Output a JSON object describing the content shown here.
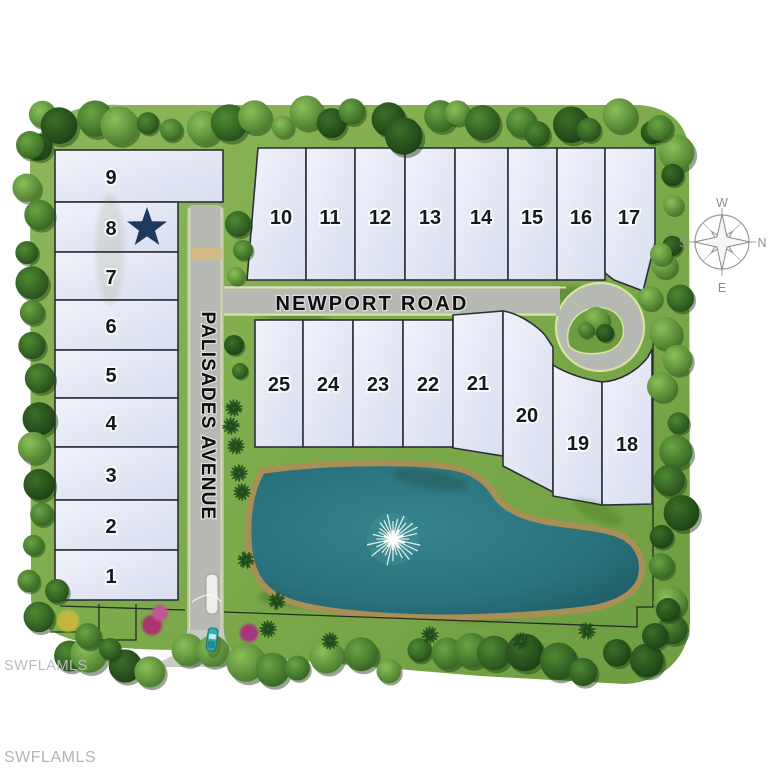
{
  "map": {
    "roads": {
      "newport": "NEWPORT ROAD",
      "palisades": "PALISADES AVENUE"
    },
    "lots": {
      "left_column": [
        "9",
        "8",
        "7",
        "6",
        "5",
        "4",
        "3",
        "2",
        "1"
      ],
      "top_row": [
        "10",
        "11",
        "12",
        "13",
        "14",
        "15",
        "16",
        "17"
      ],
      "middle_row": [
        "25",
        "24",
        "23",
        "22",
        "21",
        "20",
        "19",
        "18"
      ]
    },
    "featured_lot": {
      "number": "8",
      "marker": "star"
    },
    "compass": {
      "west": "W",
      "north": "N",
      "east": "E",
      "south": "S"
    }
  },
  "watermarks": {
    "upper": "SWFLAMLS",
    "lower": "SWFLAMLS"
  },
  "colors": {
    "lot_fill": "#e6eaf6",
    "lot_outline": "#2b3038",
    "star": "#1d3a5c",
    "water": "#2a737e",
    "lake_rim": "#a88f55",
    "grass": "#7dab4b",
    "road": "#b6b9b2",
    "road_edge": "#d6e5a0",
    "watermark": "#bdbdbd"
  }
}
